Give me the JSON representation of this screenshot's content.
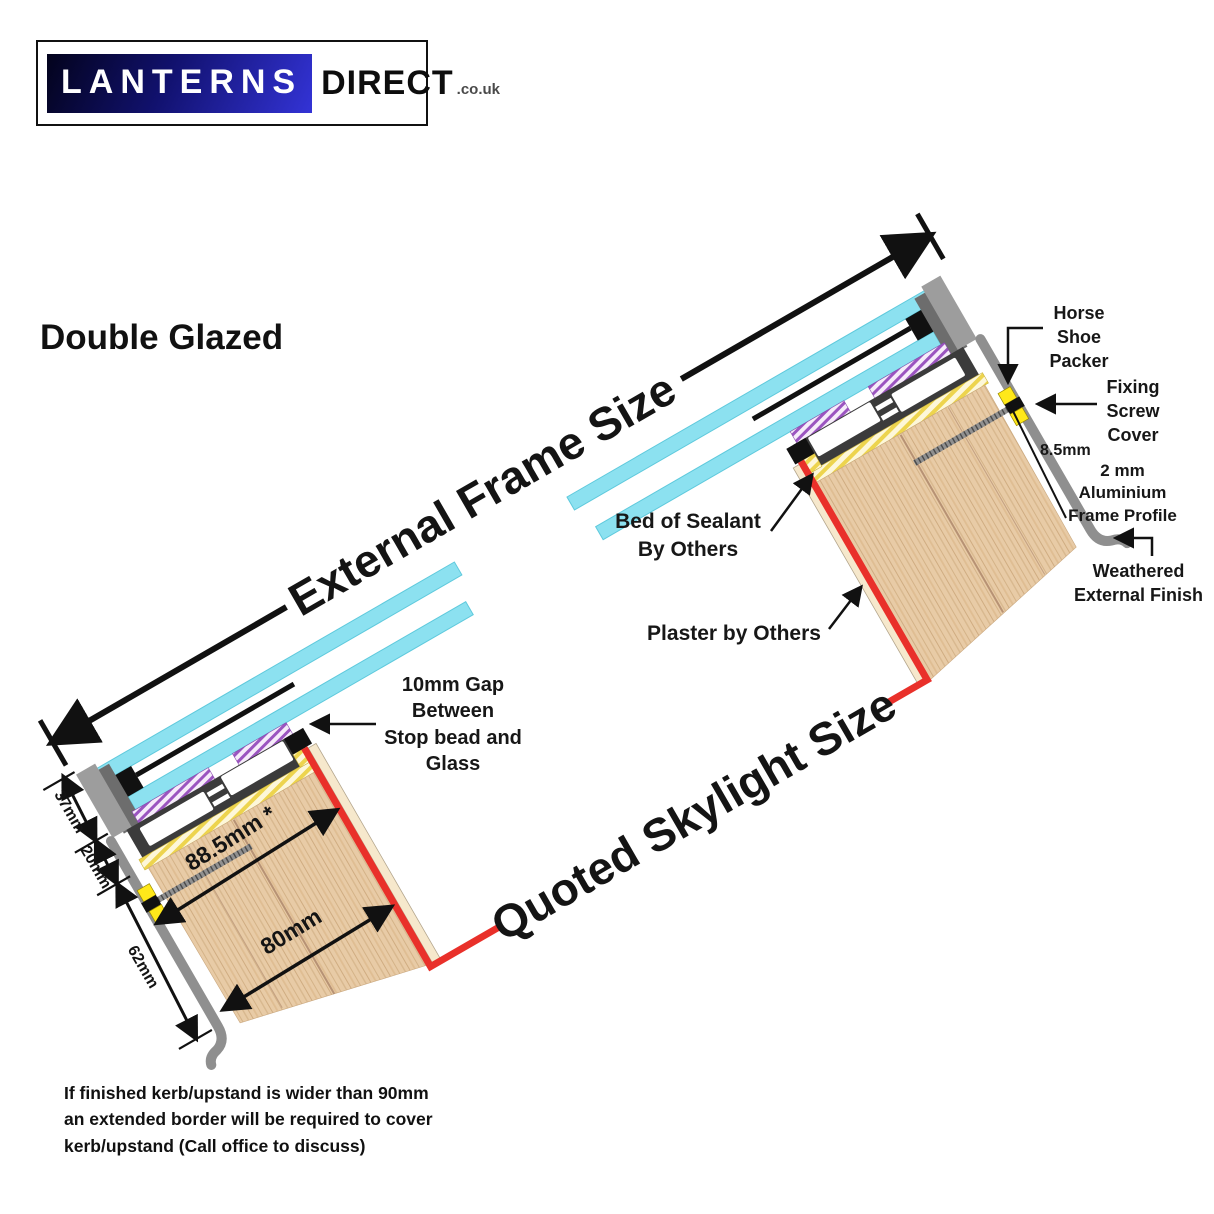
{
  "logo": {
    "primary": "LANTERNS",
    "secondary": "DIRECT",
    "tld": ".co.uk"
  },
  "title": "Double Glazed",
  "diagram": {
    "external_frame_size": "External Frame Size",
    "quoted_skylight_size": "Quoted Skylight Size",
    "labels": {
      "horse_shoe_packer": "Horse\nShoe\nPacker",
      "fixing_screw_cover": "Fixing\nScrew\nCover",
      "aluminium_frame_profile": "2 mm\nAluminium\nFrame Profile",
      "weathered_external_finish": "Weathered\nExternal Finish",
      "bed_of_sealant": "Bed of Sealant\nBy Others",
      "plaster_by_others": "Plaster by Others",
      "gap_10mm": "10mm Gap\nBetween\nStop bead and\nGlass"
    },
    "dimensions": {
      "frame_top_section": "37mm",
      "frame_bottom_section": "20mm",
      "kerb_cover": "62mm",
      "internal_cover": "88.5mm *",
      "kerb_width": "80mm",
      "profile_offset": "8.5mm"
    },
    "colors": {
      "glass": "#8ce1f0",
      "wood": "#e8cba6",
      "quoted_line": "#e9302a",
      "sealant_hatch": "#edd44e",
      "thermal_break_hatch": "#9b55c0",
      "frame": "#3b3b3b",
      "packer": "#ffe81a"
    }
  },
  "note": "If finished kerb/upstand is wider than 90mm\nan extended border will be required to cover\nkerb/upstand (Call office to discuss)"
}
